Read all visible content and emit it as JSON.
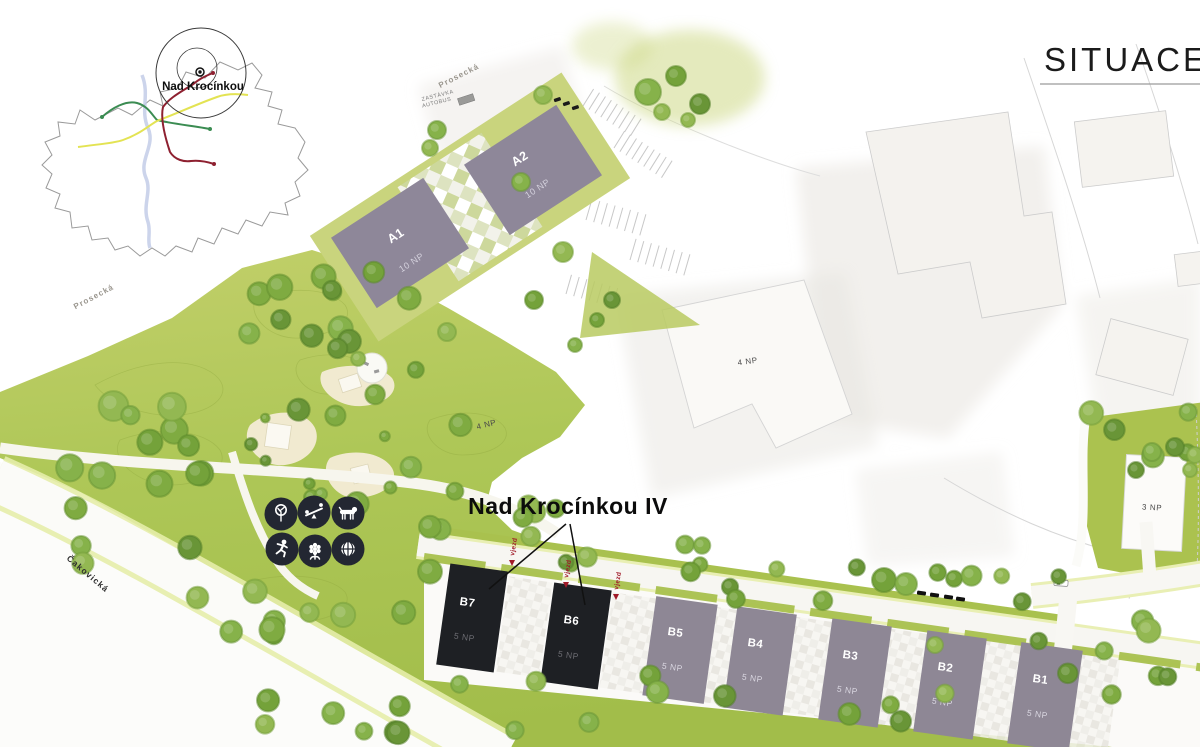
{
  "page_title": "SITUACE",
  "overview_map": {
    "place": "Nad Krocínkou"
  },
  "project": {
    "label": "Nad Krocínkou IV"
  },
  "streets": {
    "prosecka": "Prosecká",
    "cakovicka": "Čakovická"
  },
  "bus_stop": {
    "line1": "ZASTÁVKA",
    "line2": "AUTOBUS"
  },
  "buildings": {
    "a1": {
      "id": "A1",
      "floors": "10 NP"
    },
    "a2": {
      "id": "A2",
      "floors": "10 NP"
    },
    "b1": {
      "id": "B1",
      "floors": "5 NP"
    },
    "b2": {
      "id": "B2",
      "floors": "5 NP"
    },
    "b3": {
      "id": "B3",
      "floors": "5 NP"
    },
    "b4": {
      "id": "B4",
      "floors": "5 NP"
    },
    "b5": {
      "id": "B5",
      "floors": "5 NP"
    },
    "b6": {
      "id": "B6",
      "floors": "5 NP"
    },
    "b7": {
      "id": "B7",
      "floors": "5 NP"
    }
  },
  "context_buildings": {
    "west": "4 NP",
    "north": "4 NP",
    "east": "3 NP"
  },
  "markers": {
    "entrance": "vjezd"
  },
  "amenities": [
    "tree",
    "playground-seesaw",
    "dog",
    "running",
    "flower",
    "basketball"
  ],
  "colors": {
    "park_green": "#abc24f",
    "tree_green": "#74a23a",
    "building_gray": "#8e8795",
    "building_dark": "#1e2024",
    "accent_red": "#a01a28",
    "playground_cream": "#f1ead0"
  }
}
